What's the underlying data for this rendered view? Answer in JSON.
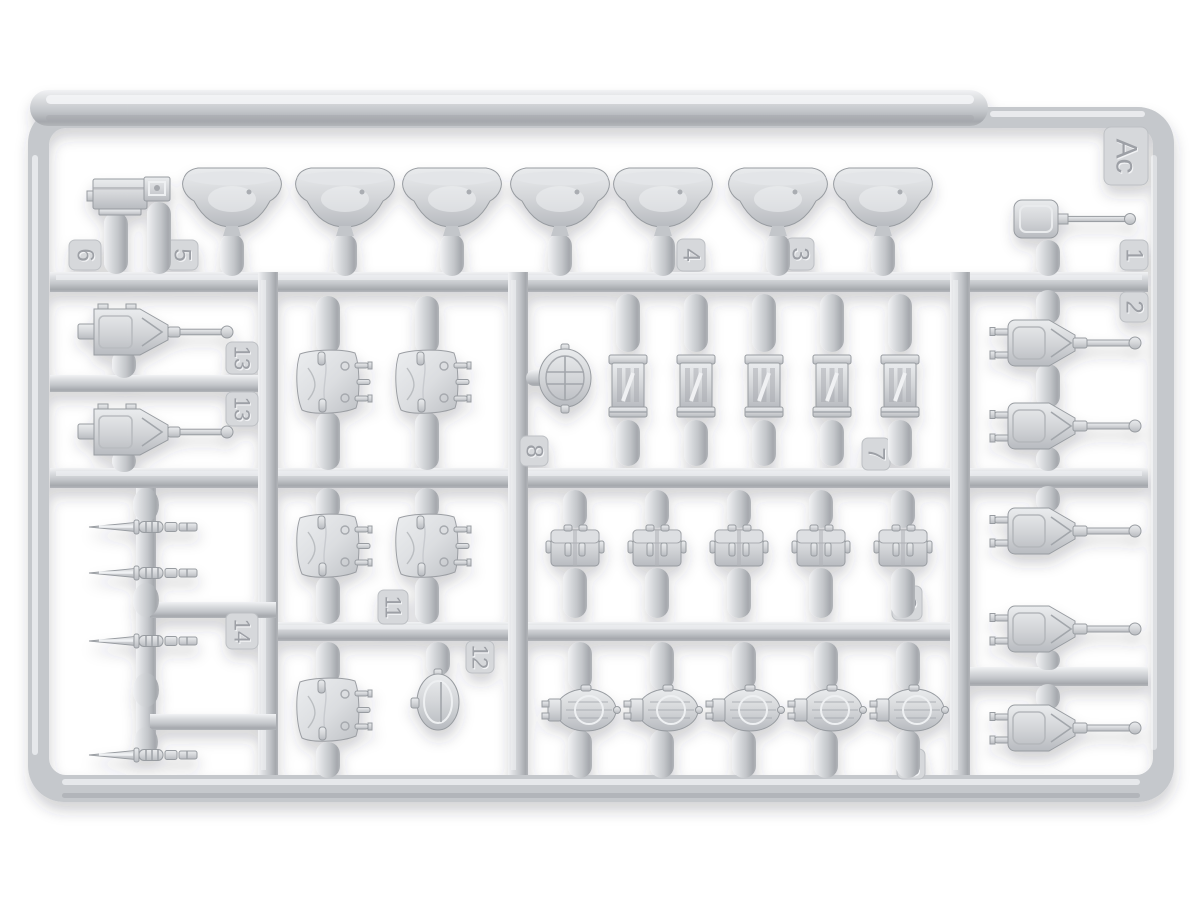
{
  "scene": {
    "description": "Photograph of a light-grey injection-molded plastic model-kit sprue (runner frame) holding military equipment parts",
    "background_color": "#ffffff",
    "plastic_color": "#c6c9cd",
    "highlight_color": "#eff1f3",
    "shadow_color": "#9da0a6"
  },
  "sprue": {
    "letter": "Ac",
    "tags": {
      "t1": "1",
      "t2": "2",
      "t3": "3",
      "t4": "4",
      "t5": "5",
      "t6": "6",
      "t7": "7",
      "t8": "8",
      "t9": "9",
      "t10": "10",
      "t11": "11",
      "t12": "12",
      "t13a": "13",
      "t13b": "13",
      "t14": "14"
    },
    "parts": [
      {
        "number": "1",
        "shape": "entrenching shovel with long handle",
        "count": 1
      },
      {
        "number": "2",
        "shape": "gun mount / turret with barrel (right column)",
        "count": 5
      },
      {
        "number": "3",
        "shape": "brimmed helmet (top row)",
        "count": 1
      },
      {
        "number": "4",
        "shape": "brimmed helmet (top row)",
        "count": 1
      },
      {
        "number": "5",
        "shape": "small square box",
        "count": 1
      },
      {
        "number": "6",
        "shape": "equipment box with side knob",
        "count": 1
      },
      {
        "number": "7",
        "shape": "cylindrical slotted canister",
        "count": 5
      },
      {
        "number": "8",
        "shape": "round ribbed lid",
        "count": 1
      },
      {
        "number": "9",
        "shape": "double ammo pouch",
        "count": 5
      },
      {
        "number": "10",
        "shape": "oval kit bag (top view)",
        "count": 5
      },
      {
        "number": "11",
        "shape": "canvas pack with straps",
        "count": 5
      },
      {
        "number": "12",
        "shape": "oval canteen / mess tin",
        "count": 1
      },
      {
        "number": "13",
        "shape": "machine-gun mount with barrel",
        "count": 2
      },
      {
        "number": "14",
        "shape": "bayonet with scabbard fittings",
        "count": 4
      }
    ],
    "helmet_row_count": 7
  }
}
